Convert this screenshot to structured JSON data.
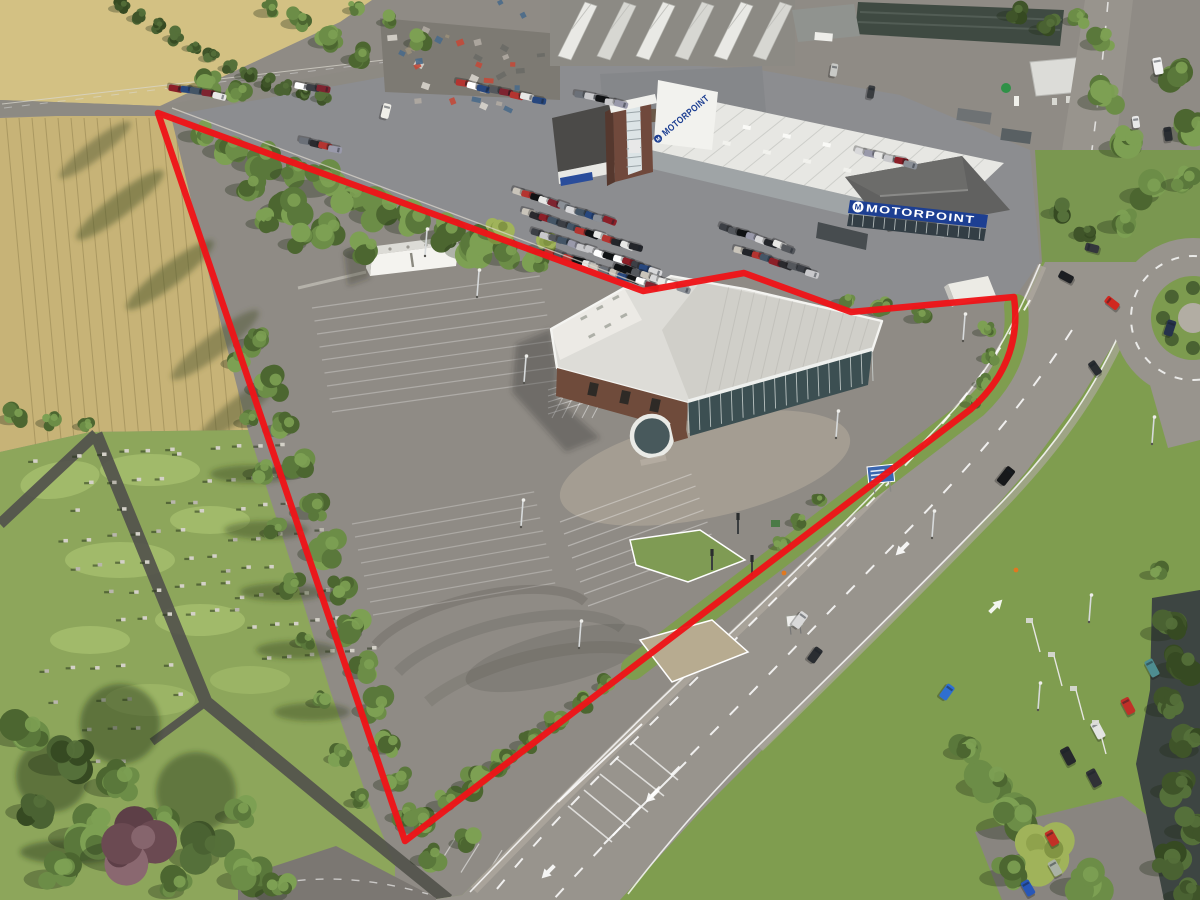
{
  "signs": {
    "motorpoint_fascia": "MOTORPOINT",
    "motorpoint_banner": "MOTORPOINT",
    "logo_letter": "M"
  },
  "boundary": {
    "color": "#ee1418",
    "path": "M 158 113 L 643 291 L 744 273 L 851 312 L 1014 297 Q 1023 362 971 409 L 405 841 Z"
  },
  "colors": {
    "boundary_red": "#ee1418",
    "motorpoint_blue": "#1d3f92",
    "field_tan": "#c7b377",
    "upper_field_tan": "#d3c183",
    "grass_green": "#7f9d4f",
    "cemetery_green": "#8da65b",
    "tarmac_grey": "#8f8b85",
    "road_grey": "#98948d",
    "roof_white": "#dddcd7"
  }
}
